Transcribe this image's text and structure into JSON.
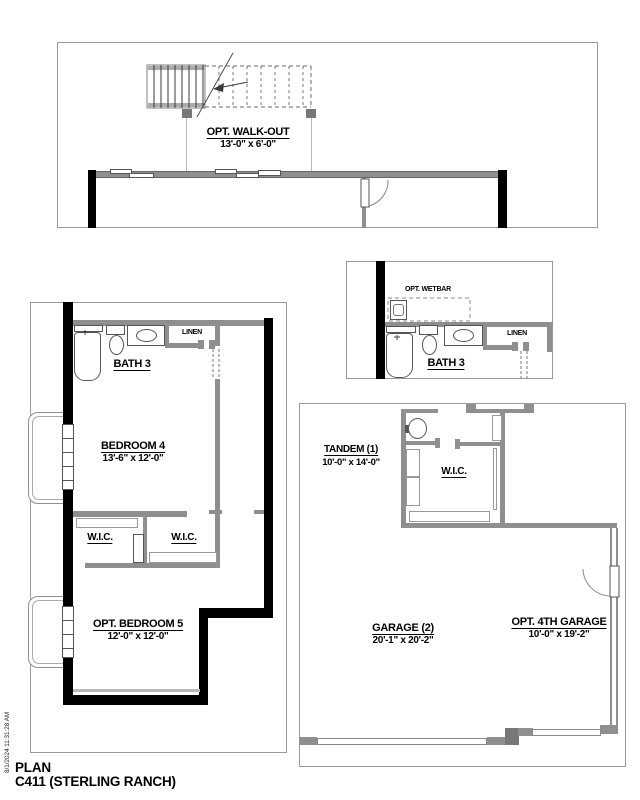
{
  "walkout": {
    "title": "OPT. WALK-OUT",
    "dims": "13'-0\" x 6'-0\""
  },
  "bath_inset": {
    "wetbar_label": "OPT. WETBAR",
    "linen_label": "LINEN",
    "bath_label": "BATH 3"
  },
  "basement": {
    "bath_label": "BATH 3",
    "linen_label": "LINEN",
    "bedroom4": {
      "name": "BEDROOM 4",
      "dims": "13'-6\" x 12'-0\""
    },
    "wic_left": "W.I.C.",
    "wic_right": "W.I.C.",
    "bedroom5": {
      "name": "OPT. BEDROOM 5",
      "dims": "12'-0\" x 12'-0\""
    }
  },
  "garage": {
    "tandem": {
      "name": "TANDEM (1)",
      "dims": "10'-0\" x 14'-0\""
    },
    "wic_label": "W.I.C.",
    "garage2": {
      "name": "GARAGE (2)",
      "dims": "20'-1\" x 20'-2\""
    },
    "garage4": {
      "name": "OPT. 4TH GARAGE",
      "dims": "10'-0\" x 19'-2\""
    }
  },
  "footer": {
    "plan_label": "PLAN",
    "plan_name": "C411 (STERLING RANCH)",
    "timestamp": "8/1/2024 11:31:28 AM"
  },
  "colors": {
    "wall_gray": "#8f8f8f",
    "black_wall": "#000000",
    "inset_border": "#9a9a9a"
  }
}
